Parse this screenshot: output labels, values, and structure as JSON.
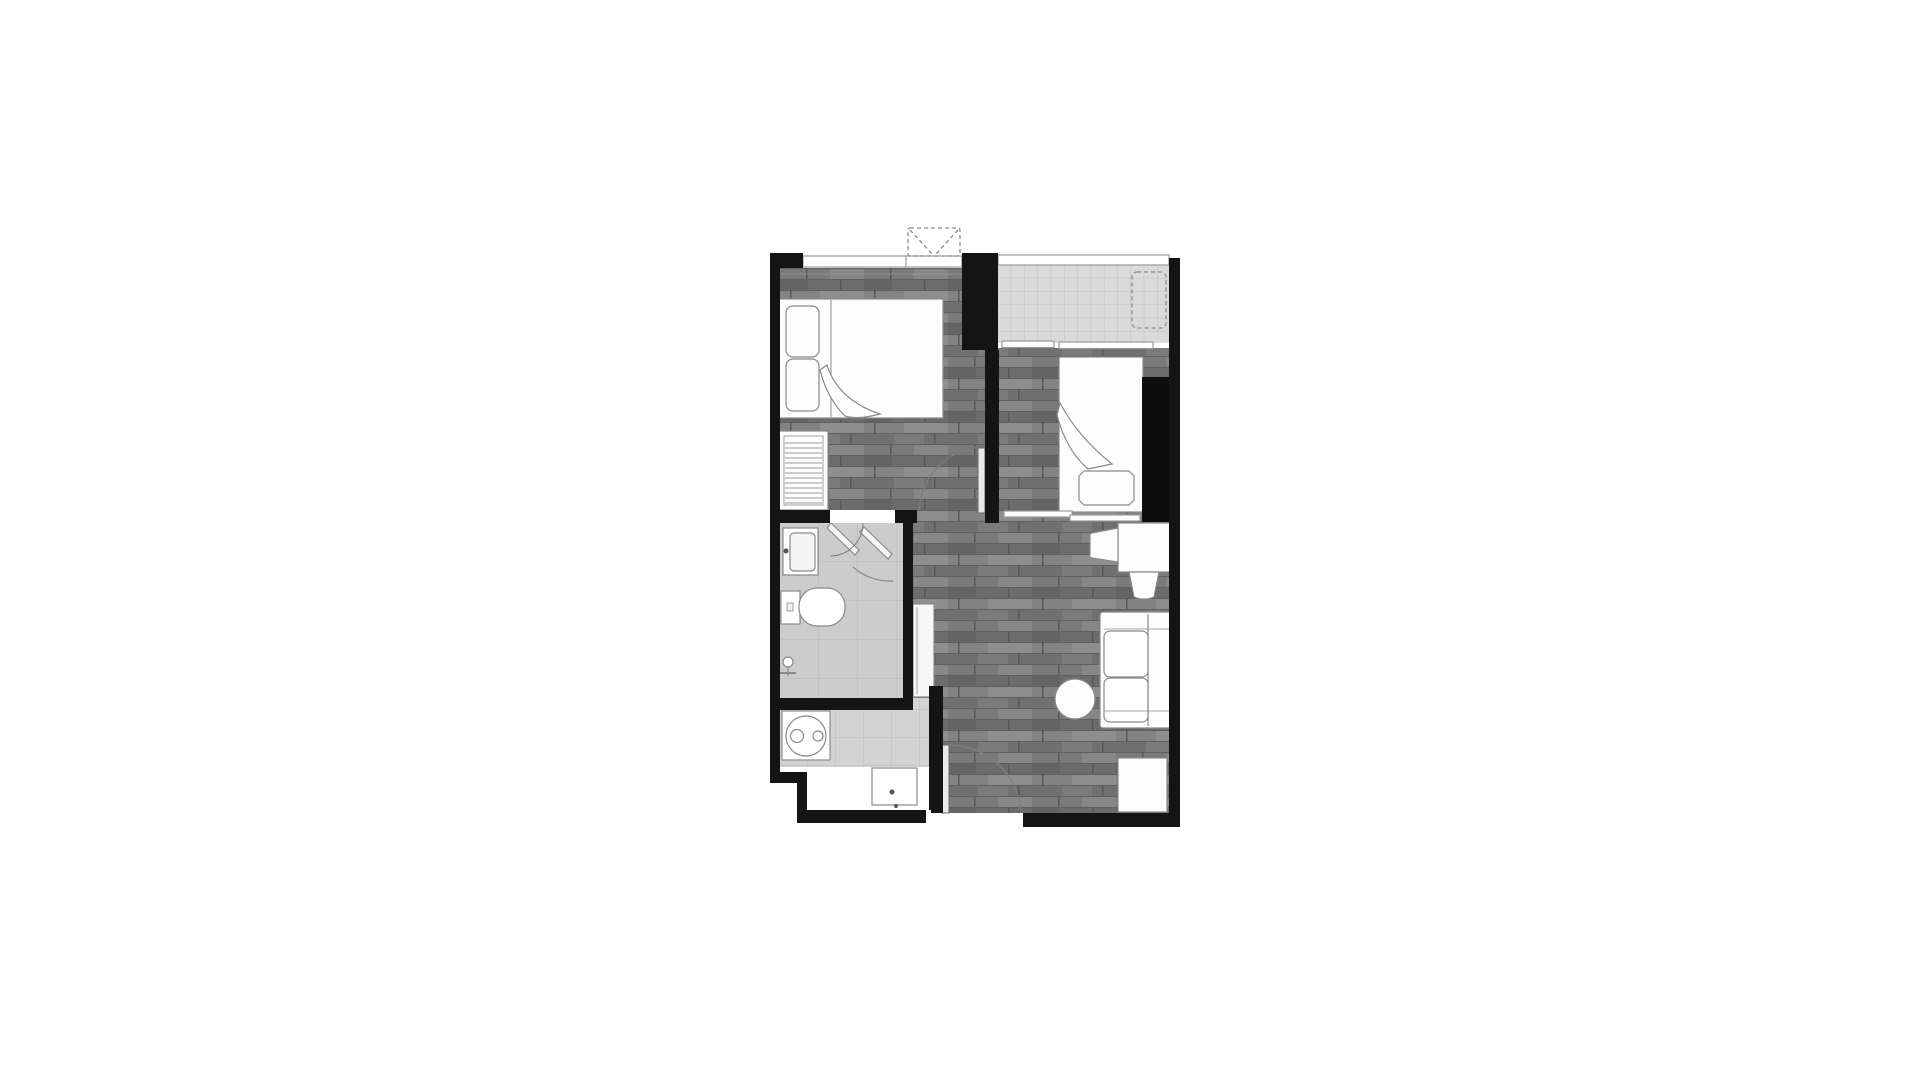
{
  "colors": {
    "background": "#ffffff",
    "wall": "#141414",
    "windowLine": "#9a9a9a",
    "fixtureFill": "#fdfdfd",
    "fixtureStroke": "#8a8a8a",
    "doorLeafFill": "#e9e9e9",
    "doorArc": "#7d7d7d",
    "panelFill": "#f2f2f2",
    "entryFloor": "#ffffff",
    "closetBlock": "#0d0d0d"
  },
  "floorplan": {
    "type": "condo-unit-floor-plan",
    "rooms": [
      {
        "name": "bedroom-1",
        "floor": "wood",
        "fixtures": [
          "double-bed",
          "pillow",
          "pillow",
          "duvet-fold",
          "wardrobe",
          "window",
          "swing-door"
        ]
      },
      {
        "name": "balcony",
        "floor": "tile",
        "fixtures": [
          "ac-condenser-dashed",
          "railing",
          "sliding-window"
        ]
      },
      {
        "name": "bedroom-2",
        "floor": "wood",
        "fixtures": [
          "single-bed",
          "blanket-fold",
          "foot-cushion",
          "built-in-closet-block",
          "sliding-door"
        ]
      },
      {
        "name": "bathroom",
        "floor": "tile",
        "fixtures": [
          "wash-basin",
          "toilet",
          "shower-head",
          "double-swing-door"
        ]
      },
      {
        "name": "kitchen-laundry",
        "floor": "tile",
        "fixtures": [
          "washing-machine",
          "sink-counter",
          "pocket-door-panel"
        ]
      },
      {
        "name": "living-dining",
        "floor": "wood",
        "fixtures": [
          "desk",
          "chair",
          "stool",
          "sofa",
          "round-side-table",
          "shoe-cabinet",
          "entrance-door"
        ]
      }
    ],
    "outside": [
      "ac-condenser-dashed-top"
    ]
  }
}
